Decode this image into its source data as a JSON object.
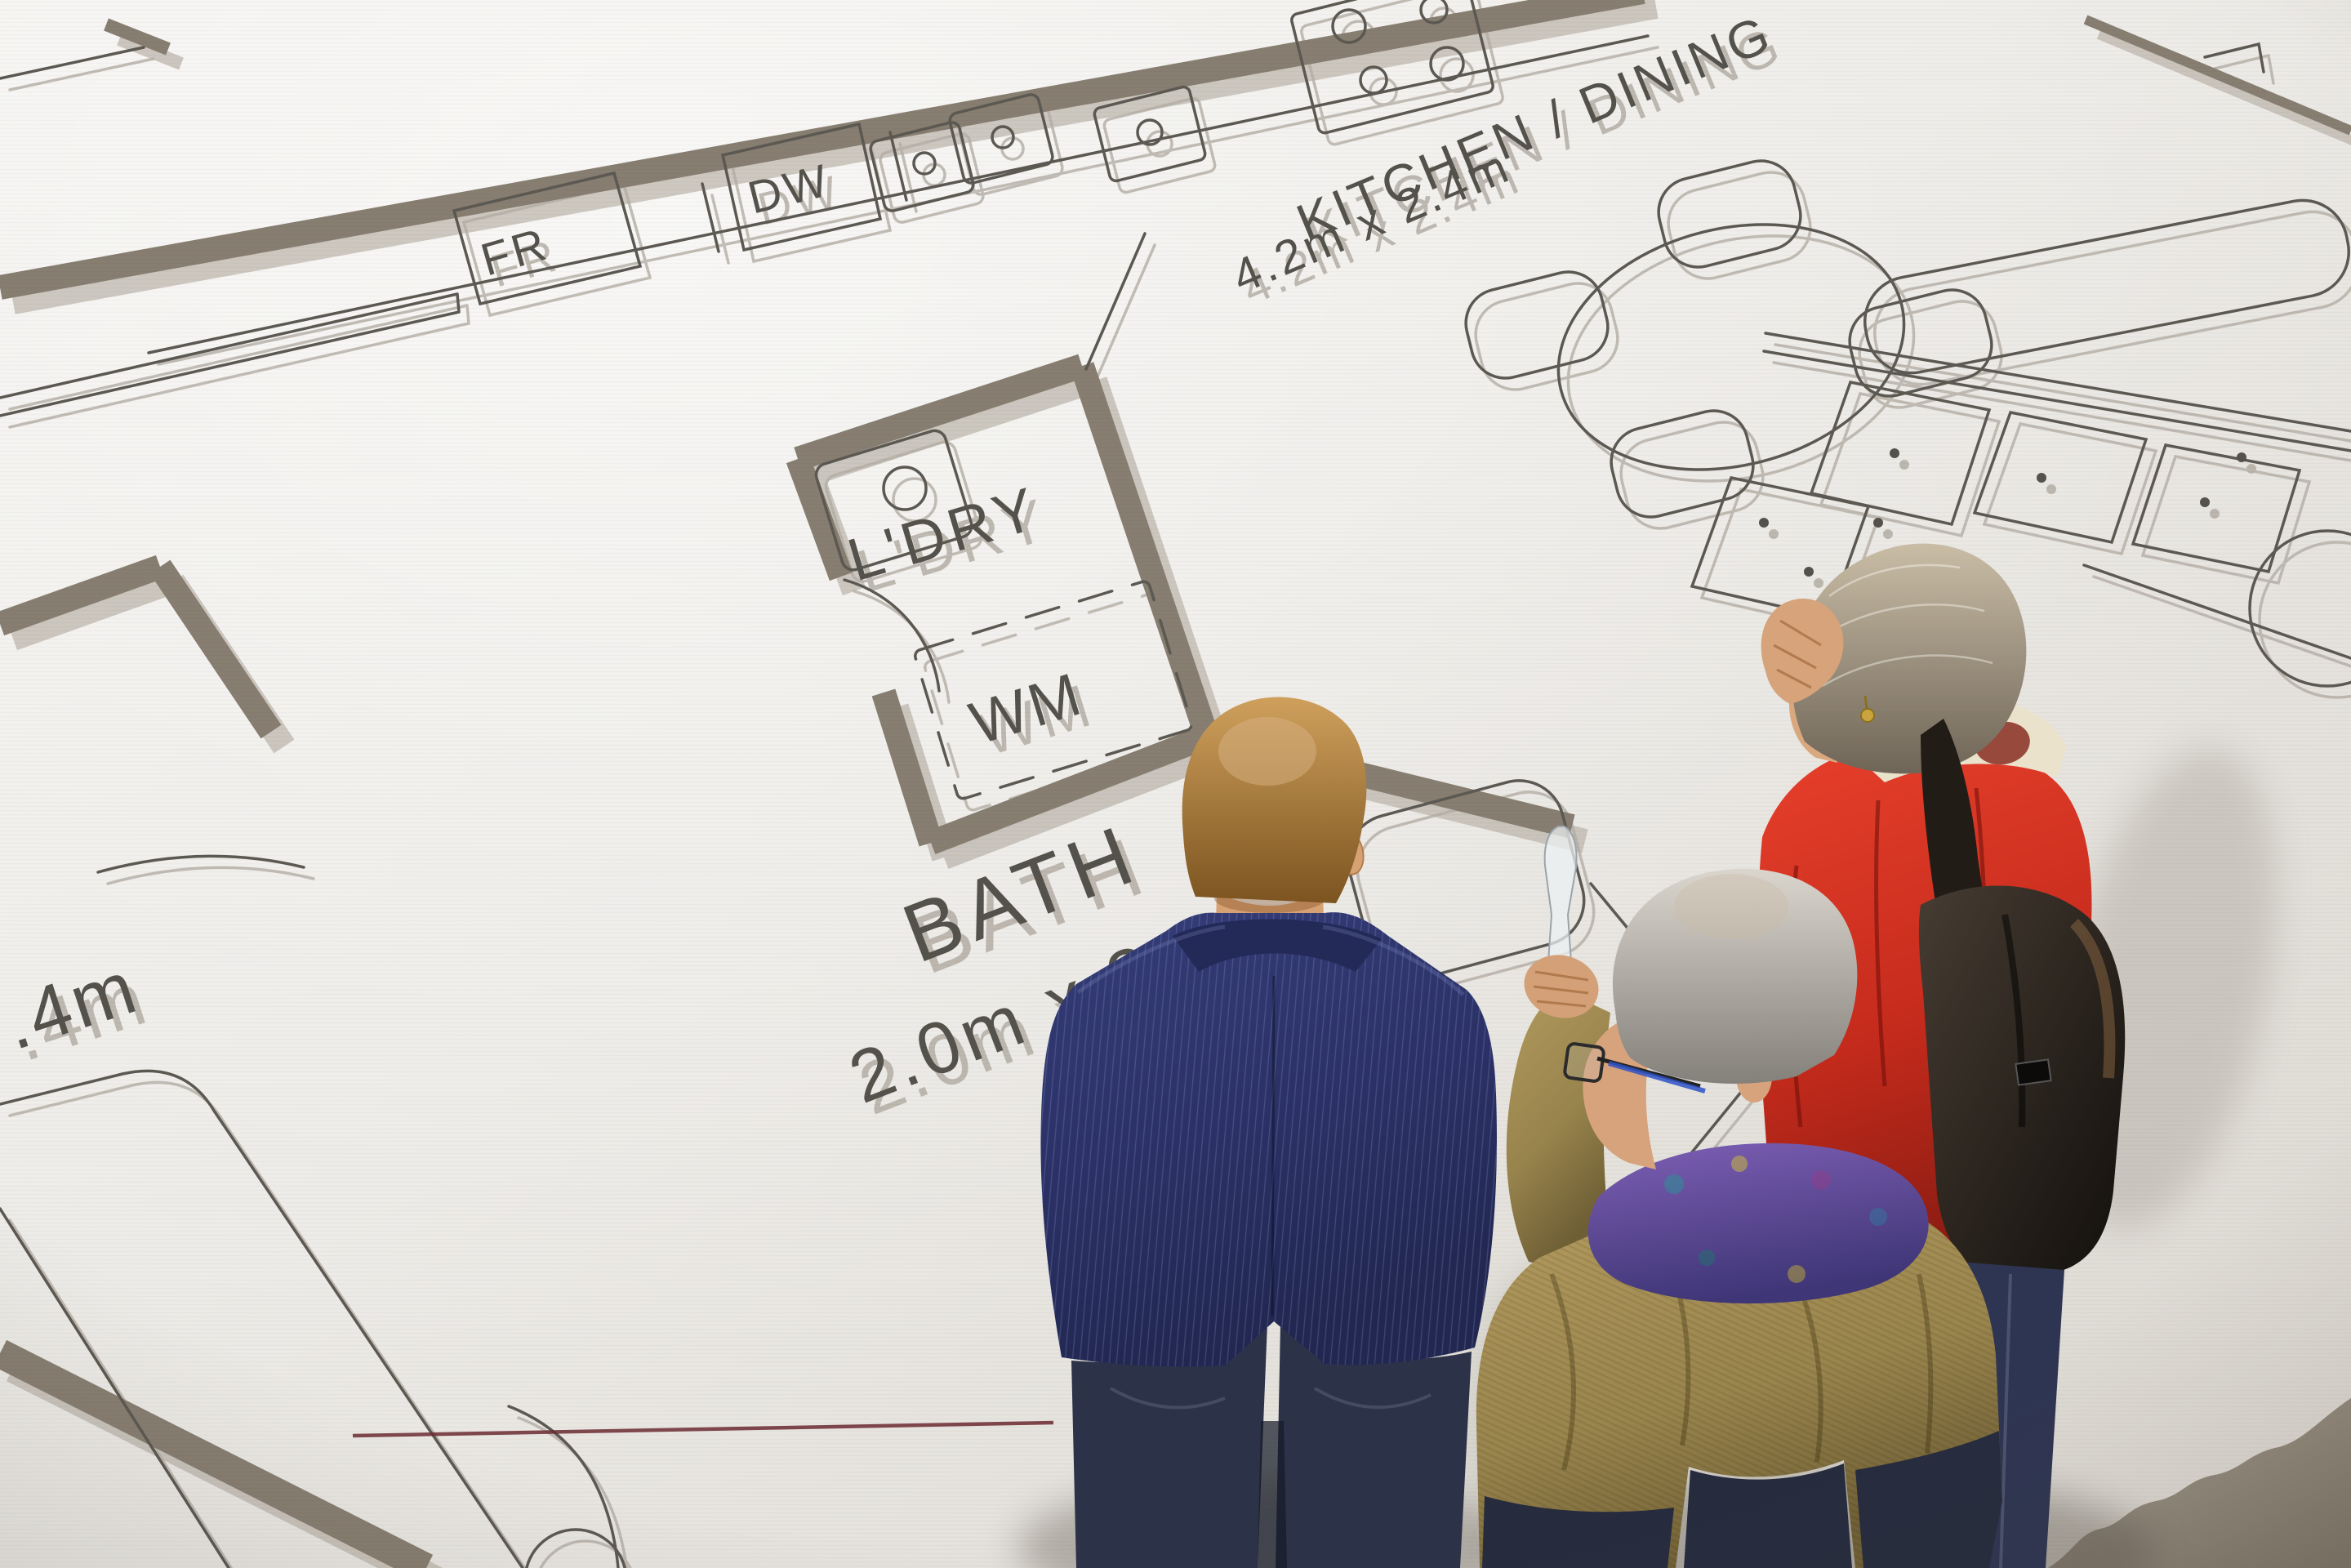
{
  "plan": {
    "labels": {
      "kitchen_dining": "KITCHEN / DINING",
      "kitchen_dining_dims": "4.2m x 2.4m",
      "laundry": "L'DRY",
      "washing_machine": "WM",
      "dishwasher": "DW",
      "fridge": "FR",
      "bath": "BATH",
      "bath_dims": "2.0m x 2.0m",
      "left_edge_partial_dim": ".4m"
    },
    "colors": {
      "wall": "#877e71",
      "wall_shadow": "#bab3aa",
      "line": "#5c5852",
      "line_shadow": "#b4aea5",
      "text": "#55524c",
      "accent_red_line": "#6b2a31"
    }
  },
  "people": {
    "suit_man": {
      "hair": "#b07c3c",
      "jacket": "#2c3267",
      "jeans": "#2c3248"
    },
    "older_man": {
      "hair": "#b6b1a9",
      "jacket": "#9a8750",
      "scarf": "#6a50a4",
      "jeans": "#262c3e"
    },
    "older_woman": {
      "hair": "#a2957f",
      "sweater": "#d22f1e",
      "backpack": "#221c17",
      "jeans": "#2e3552"
    }
  },
  "floor": {
    "light": "#f3f1ee",
    "mid": "#ece9e4",
    "dark_edge": "#8d8478"
  }
}
